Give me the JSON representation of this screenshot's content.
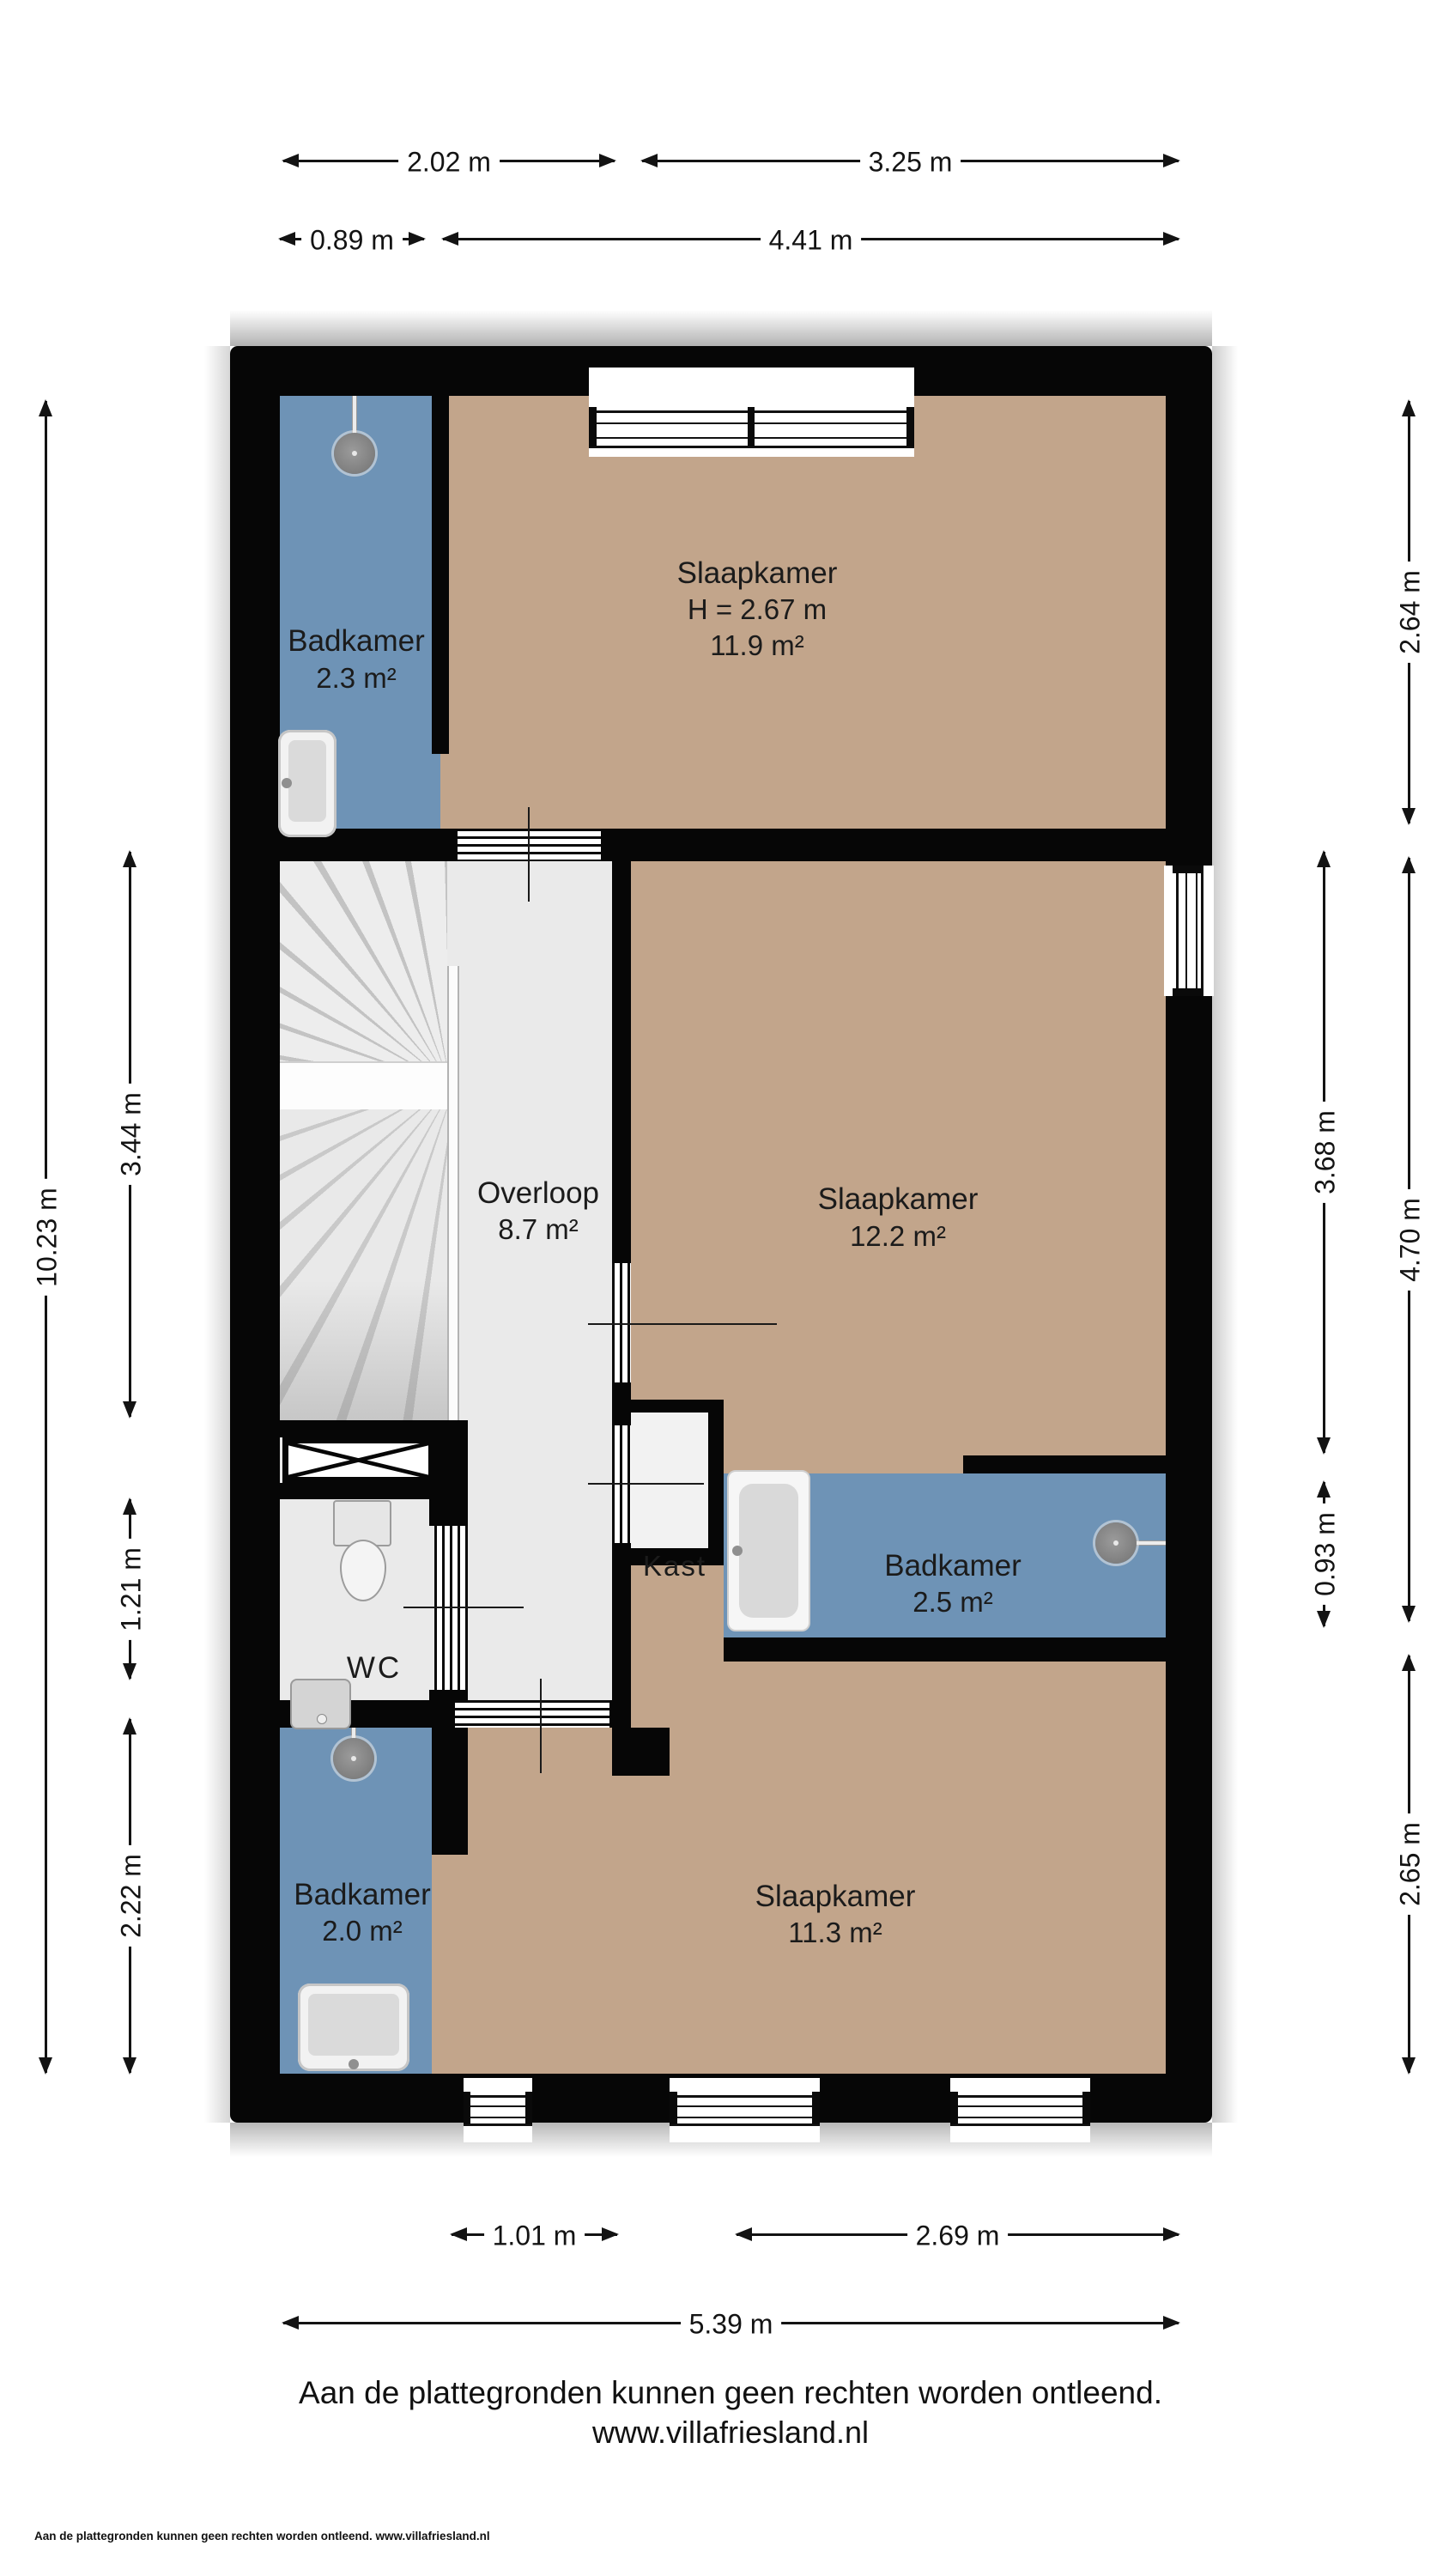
{
  "rooms": {
    "badkamer_top": {
      "name": "Badkamer",
      "area": "2.3 m²"
    },
    "slaapkamer_top": {
      "name": "Slaapkamer",
      "ceiling_height": "H = 2.67 m",
      "area": "11.9 m²"
    },
    "overloop": {
      "name": "Overloop",
      "area": "8.7 m²"
    },
    "slaapkamer_mid": {
      "name": "Slaapkamer",
      "area": "12.2 m²"
    },
    "kast": {
      "name": "Kast"
    },
    "badkamer_mid": {
      "name": "Badkamer",
      "area": "2.5 m²"
    },
    "wc": {
      "name": "WC"
    },
    "badkamer_bottom": {
      "name": "Badkamer",
      "area": "2.0 m²"
    },
    "slaapkamer_bottom": {
      "name": "Slaapkamer",
      "area": "11.3 m²"
    }
  },
  "dimensions": {
    "top_left": "2.02 m",
    "top_right": "3.25 m",
    "top2_left": "0.89 m",
    "top2_right": "4.41 m",
    "bottom_left": "1.01 m",
    "bottom_right": "2.69 m",
    "bottom_total": "5.39 m",
    "left_total": "10.23 m",
    "left_stairs": "3.44 m",
    "left_wc": "1.21 m",
    "left_badkamer": "2.22 m",
    "right_inner_top": "3.68 m",
    "right_inner_bottom": "0.93 m",
    "right_outer_top": "2.64 m",
    "right_outer_mid": "4.70 m",
    "right_outer_bottom": "2.65 m"
  },
  "footer": {
    "disclaimer": "Aan de plattegronden kunnen geen rechten worden ontleend.",
    "website": "www.villafriesland.nl",
    "footnote": "Aan de plattegronden kunnen geen rechten worden ontleend. www.villafriesland.nl"
  },
  "colors": {
    "wall": "#060606",
    "bedroom_floor": "#C2A58B",
    "bathroom_floor": "#6E93B6",
    "hall_floor": "#EAEAEA",
    "closet_floor": "#F2F2F2"
  }
}
